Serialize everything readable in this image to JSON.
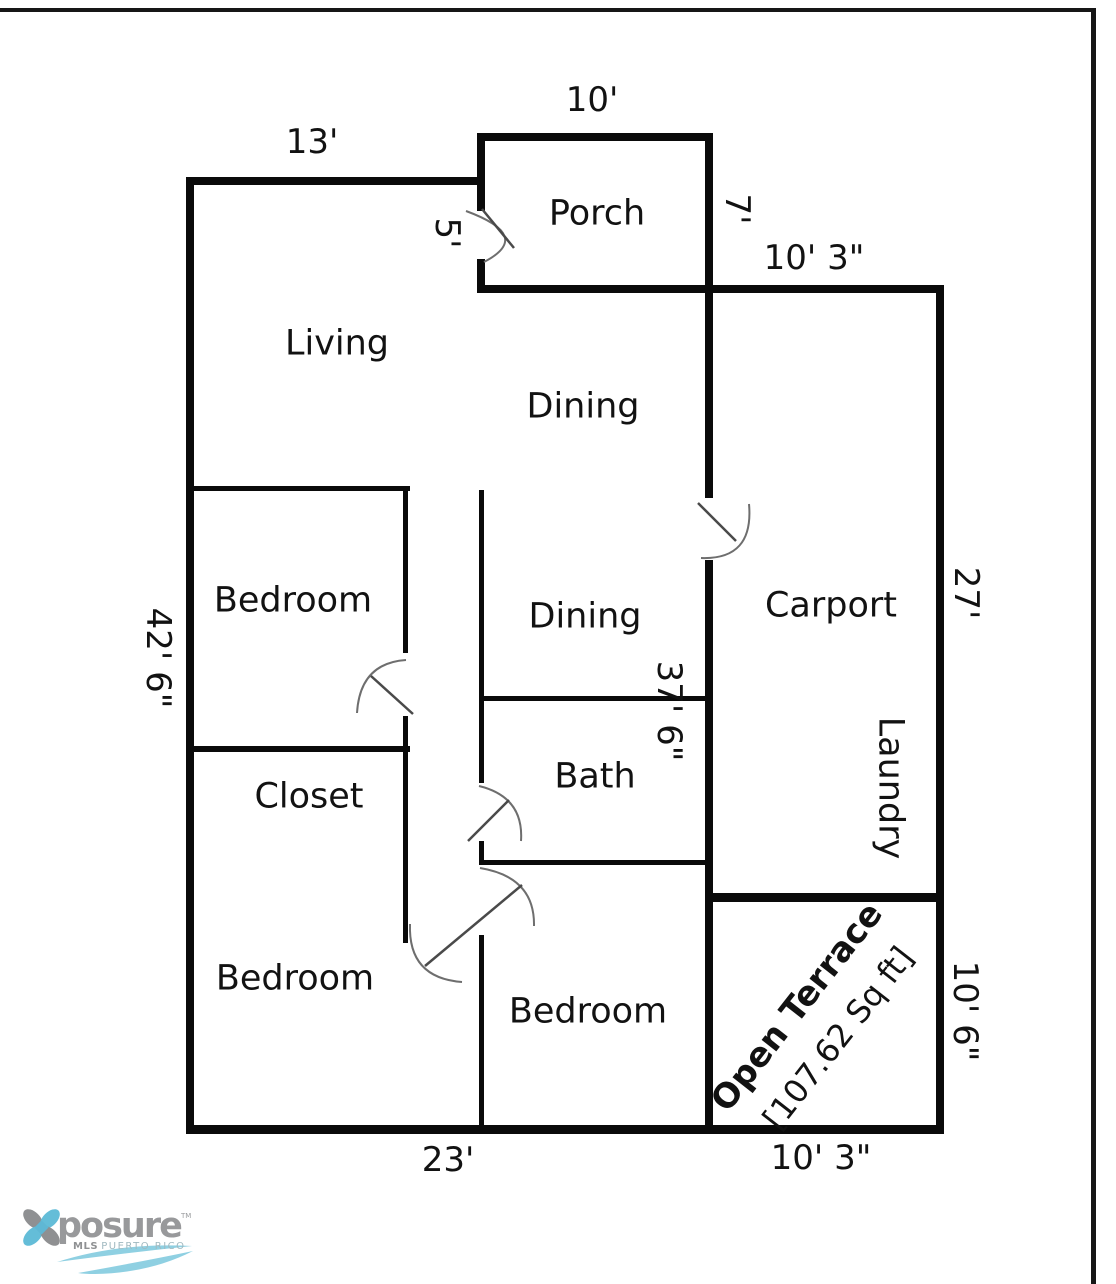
{
  "plan": {
    "rooms": {
      "porch": "Porch",
      "living": "Living",
      "dining_upper": "Dining",
      "dining_lower": "Dining",
      "bedroom_1": "Bedroom",
      "closet": "Closet",
      "bath": "Bath",
      "carport": "Carport",
      "laundry": "Laundry",
      "bedroom_2": "Bedroom",
      "bedroom_3": "Bedroom",
      "open_terrace": "Open Terrace",
      "terrace_area": "[107.62 Sq ft]"
    },
    "dimensions": {
      "top_living": "13'",
      "top_porch": "10'",
      "porch_door": "5'",
      "porch_right": "7'",
      "carport_top": "10' 3\"",
      "left_height": "42' 6\"",
      "hall_height": "37' 6\"",
      "carport_right": "27'",
      "terrace_right": "10' 6\"",
      "bottom_left": "23'",
      "bottom_terrace": "10' 3\""
    },
    "colors": {
      "wall": "#0a0a0a",
      "door_arc": "#6e6e6e",
      "door_leaf": "#4a4a4a"
    }
  },
  "logo": {
    "brand": "posure",
    "tm": "TM",
    "sub_bold": "MLS",
    "sub_rest": "PUERTO RICO",
    "colors": {
      "gray": "#8f9092",
      "blue": "#64bdd8",
      "wave_blue": "#8fd0e2"
    }
  }
}
